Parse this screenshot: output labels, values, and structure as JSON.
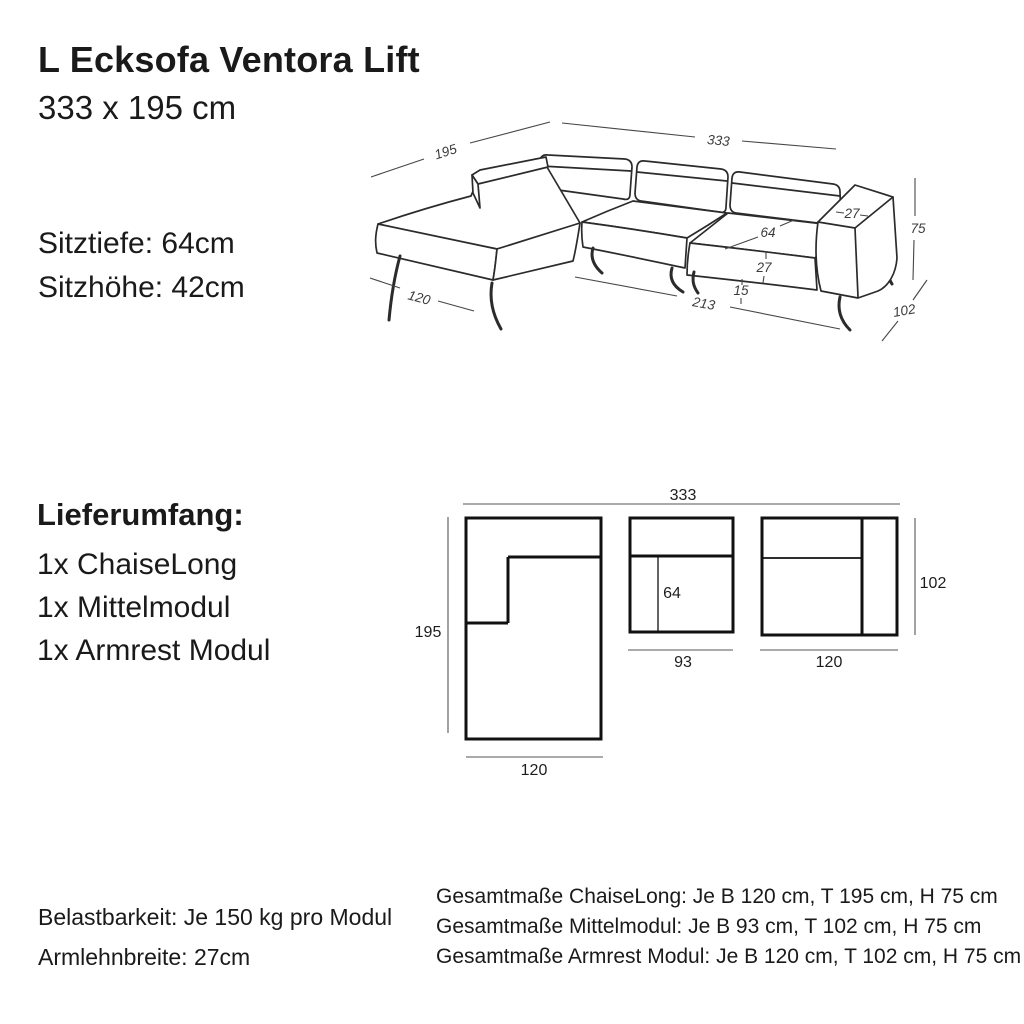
{
  "header": {
    "title": "L Ecksofa Ventora Lift",
    "subtitle": "333 x 195 cm"
  },
  "specs": {
    "seat_depth_label": "Sitztiefe: 64cm",
    "seat_height_label": "Sitzhöhe: 42cm"
  },
  "delivery": {
    "heading": "Lieferumfang:",
    "items": [
      "1x ChaiseLong",
      "1x Mittelmodul",
      "1x Armrest Modul"
    ]
  },
  "sofa_drawing": {
    "total_depth": "195",
    "total_width": "333",
    "chaise_width": "120",
    "seat_span": "213",
    "seat_depth": "64",
    "armrest_top_width": "27",
    "cushion_height": "27",
    "base_height": "15",
    "total_height": "75",
    "side_depth": "102"
  },
  "module_diagram": {
    "total_width": "333",
    "chaise": {
      "depth": "195",
      "width": "120"
    },
    "middle": {
      "seat_depth": "64",
      "width": "93"
    },
    "armrest": {
      "depth": "102",
      "width": "120"
    }
  },
  "notes_left": {
    "lines": [
      "Belastbarkeit: Je 150 kg pro Modul",
      "Armlehnbreite: 27cm"
    ]
  },
  "notes_right": {
    "lines": [
      "Gesamtmaße ChaiseLong: Je B 120 cm, T 195 cm, H 75 cm",
      "Gesamtmaße Mittelmodul: Je B 93 cm, T 102 cm, H 75 cm",
      "Gesamtmaße Armrest Modul: Je B 120 cm, T 102 cm, H 75 cm"
    ]
  },
  "colors": {
    "ink": "#1a1a1a",
    "line": "#2b2b2b",
    "dimension": "#464646",
    "background": "#ffffff"
  }
}
